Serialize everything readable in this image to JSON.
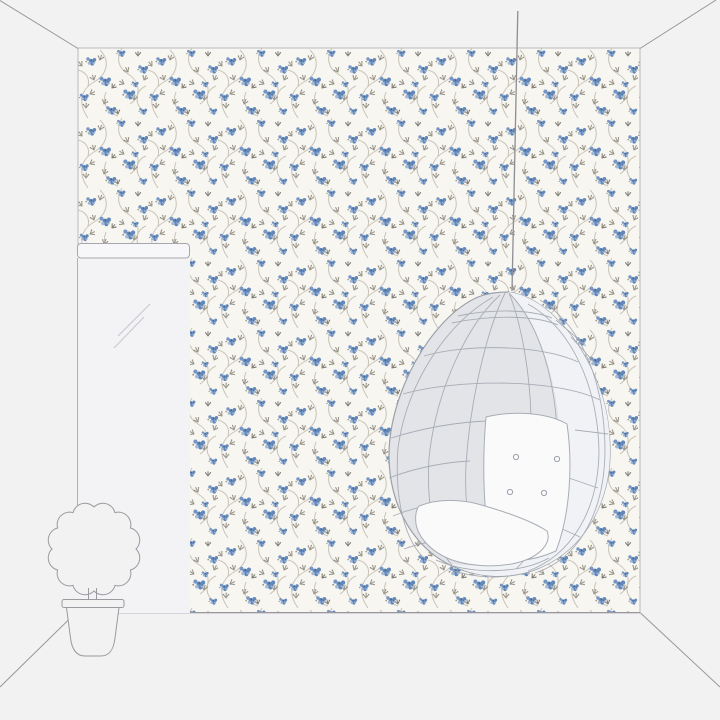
{
  "scene": {
    "kind": "wallpaper-room-mockup",
    "caption": "Room mockup: floral trail wallpaper wall with hanging egg chair, wall mirror and potted topiary plant",
    "elements": {
      "wallpaper": "Floral trail wallpaper wall",
      "ceiling_left": "Left ceiling corner line",
      "ceiling_right": "Right ceiling corner line",
      "floor": "Floor and wall base lines",
      "mirror": "Tall wall mirror",
      "mirror_frame": "Mirror top frame bar",
      "mirror_reflection": "Mirror reflection highlight",
      "plant": "Potted topiary plant",
      "plant_foliage": "Round scalloped foliage",
      "plant_trunk": "Plant trunk",
      "plant_pot": "Plant pot",
      "chair": "Hanging rattan egg chair",
      "chair_cord": "Chair hanging cord",
      "chair_back_cushion": "Tufted back cushion",
      "chair_seat_cushion": "Seat cushion"
    }
  },
  "colors": {
    "background": "#f2f2f3",
    "wallpaper_base": "#f8f6f1",
    "wallpaper_stem": "#c9c3b7",
    "wallpaper_leaf": "#99958a",
    "wallpaper_leaf_dark": "#807c72",
    "wallpaper_flower": "#6288ba",
    "wallpaper_flower_dark": "#41689c",
    "wallpaper_flower_light": "#a4b9d6",
    "room_outline": "#97979d",
    "wallpaper_edge": "#b9b9bf",
    "chair_body": "#e3e4e8",
    "chair_highlight": "#f1f2f5",
    "chair_line": "#a2a7b0",
    "cushion": "#fafafb",
    "mirror_panel": "#f3f3f5",
    "mirror_bar": "#f7f7f9"
  }
}
